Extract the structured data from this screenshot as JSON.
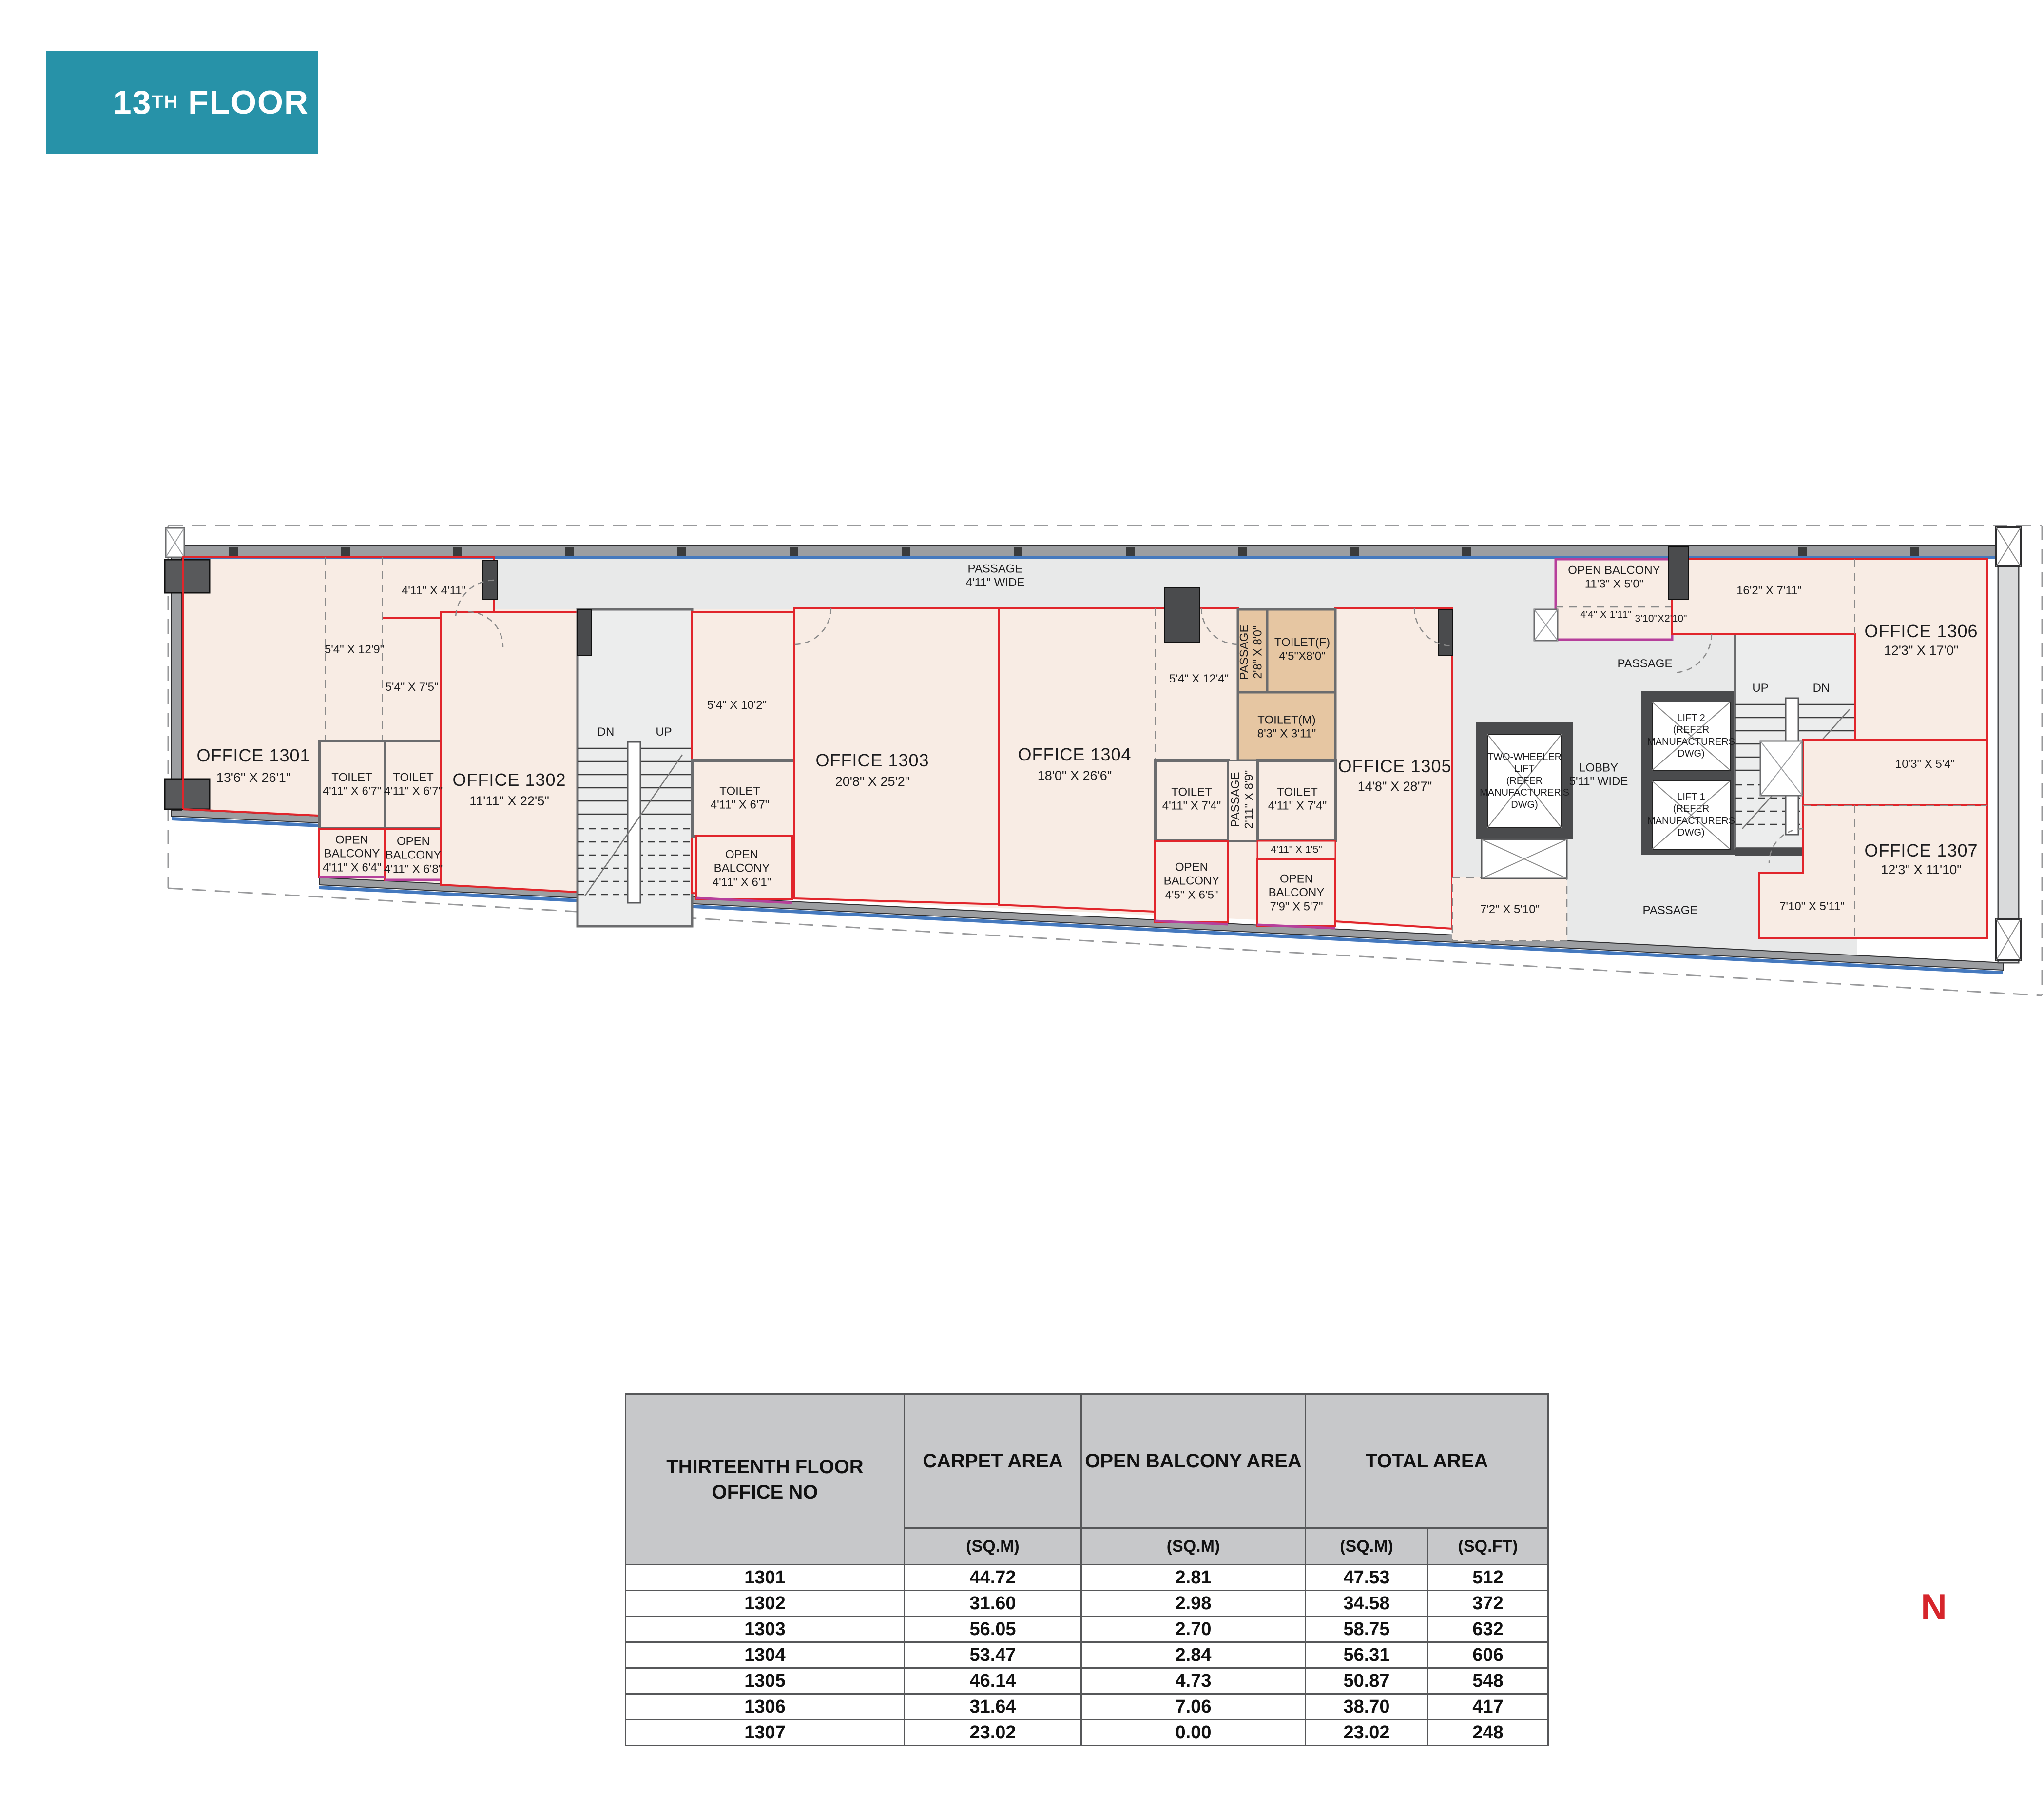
{
  "title": {
    "floor_number": "13",
    "ordinal": "TH",
    "floor_word": "FLOOR"
  },
  "colors": {
    "banner_teal": "#2792A8",
    "outline_red": "#E1252B",
    "balcony_purple": "#B63F9B",
    "wall_blue": "#4579BE",
    "room_pink": "#F8ECE4",
    "toilet_tan": "#E6C6A2",
    "compass_red": "#D6252B"
  },
  "plan": {
    "offices": [
      {
        "name": "OFFICE 1301",
        "dims": "13'6\" X 26'1\""
      },
      {
        "name": "OFFICE 1302",
        "dims": "11'11\" X 22'5\""
      },
      {
        "name": "OFFICE 1303",
        "dims": "20'8\" X 25'2\""
      },
      {
        "name": "OFFICE 1304",
        "dims": "18'0\" X 26'6\""
      },
      {
        "name": "OFFICE 1305",
        "dims": "14'8\" X 28'7\""
      },
      {
        "name": "OFFICE 1306",
        "dims": "12'3\" X 17'0\""
      },
      {
        "name": "OFFICE 1307",
        "dims": "12'3\" X 11'10\""
      }
    ],
    "toilets": [
      "TOILET\n4'11\" X 6'7\"",
      "TOILET\n4'11\" X 6'7\"",
      "TOILET\n4'11\" X 6'7\"",
      "TOILET(F)\n4'5\"X8'0\"",
      "TOILET(M)\n8'3\" X 3'11\"",
      "TOILET\n4'11\" X 7'4\"",
      "TOILET\n4'11\" X 7'4\""
    ],
    "balconies": [
      "OPEN\nBALCONY\n4'11\" X 6'4\"",
      "OPEN\nBALCONY\n4'11\" X 6'8\"",
      "OPEN\nBALCONY\n4'11\" X 6'1\"",
      "OPEN\nBALCONY\n4'5\" X 6'5\"",
      "OPEN\nBALCONY\n7'9\" X 5'7\"",
      "OPEN BALCONY\n11'3\" X 5'0\""
    ],
    "dims": [
      "4'11\" X 4'11\"",
      "5'4\" X 12'9\"",
      "5'4\" X 7'5\"",
      "5'4\" X 10'2\"",
      "5'4\" X 12'4\"",
      "4'11\" X 1'5\"",
      "16'2\" X 7'11\"",
      "4'4\" X 1'11\"",
      "3'10\"X2'10\"",
      "10'3\" X 5'4\"",
      "7'2\" X 5'10\"",
      "7'10\" X 5'11\""
    ],
    "passages": {
      "top": "PASSAGE\n4'11\" WIDE",
      "v1": "PASSAGE\n2'8\" X 8'0\"",
      "v2": "PASSAGE\n2'11\" X 8'9\"",
      "right_top": "PASSAGE",
      "right_bottom": "PASSAGE"
    },
    "core": {
      "two_wheeler_lift": "TWO-WHEELER\nLIFT\n(REFER\nMANUFACTURER'S\nDWG)",
      "lift2": "LIFT 2\n(REFER\nMANUFACTURERS\nDWG)",
      "lift1": "LIFT 1\n(REFER\nMANUFACTURERS\nDWG)",
      "lobby": "LOBBY\n5'11\" WIDE"
    },
    "stairs": {
      "left_dn": "DN",
      "left_up": "UP",
      "right_up": "UP",
      "right_dn": "DN"
    }
  },
  "table": {
    "col_office": "THIRTEENTH FLOOR\nOFFICE NO",
    "col_carpet": "CARPET AREA",
    "col_balcony": "OPEN BALCONY AREA",
    "col_total": "TOTAL AREA",
    "unit_sqm": "(SQ.M)",
    "unit_sqft": "(SQ.FT)",
    "rows": [
      {
        "office": "1301",
        "carpet": "44.72",
        "balcony": "2.81",
        "total_sqm": "47.53",
        "total_sqft": "512"
      },
      {
        "office": "1302",
        "carpet": "31.60",
        "balcony": "2.98",
        "total_sqm": "34.58",
        "total_sqft": "372"
      },
      {
        "office": "1303",
        "carpet": "56.05",
        "balcony": "2.70",
        "total_sqm": "58.75",
        "total_sqft": "632"
      },
      {
        "office": "1304",
        "carpet": "53.47",
        "balcony": "2.84",
        "total_sqm": "56.31",
        "total_sqft": "606"
      },
      {
        "office": "1305",
        "carpet": "46.14",
        "balcony": "4.73",
        "total_sqm": "50.87",
        "total_sqft": "548"
      },
      {
        "office": "1306",
        "carpet": "31.64",
        "balcony": "7.06",
        "total_sqm": "38.70",
        "total_sqft": "417"
      },
      {
        "office": "1307",
        "carpet": "23.02",
        "balcony": "0.00",
        "total_sqm": "23.02",
        "total_sqft": "248"
      }
    ]
  },
  "compass": {
    "north": "N"
  }
}
